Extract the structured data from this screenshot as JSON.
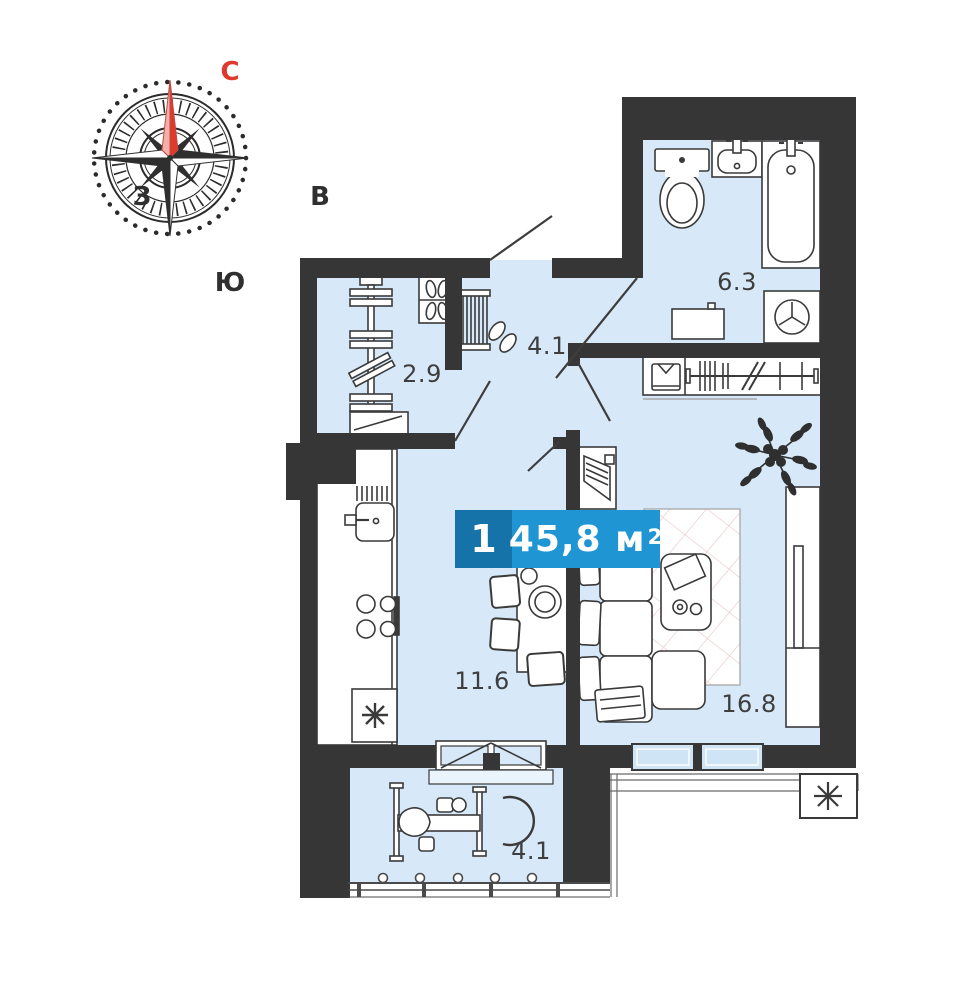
{
  "title": "Floor plan of 1-room apartment",
  "compass": {
    "north": "С",
    "east": "В",
    "south": "Ю",
    "west": "З"
  },
  "badge": {
    "count": "1",
    "area": "45,8",
    "unit": "м",
    "superscript": "2"
  },
  "rooms": [
    {
      "name": "storage",
      "label": "2.9"
    },
    {
      "name": "hallway",
      "label": "4.1"
    },
    {
      "name": "bathroom",
      "label": "6.3"
    },
    {
      "name": "kitchen",
      "label": "11.6"
    },
    {
      "name": "living-room",
      "label": "16.8"
    },
    {
      "name": "balcony",
      "label": "4.1"
    }
  ],
  "colors": {
    "wall": "#363636",
    "room_fill": "#d7e9f8",
    "window_glass": "#cfe5f6",
    "badge_dark": "#1673aa",
    "badge_light": "#2095d3",
    "north_red": "#df382d",
    "rug_line": "#eac9c9",
    "outline": "#3a3a3a"
  },
  "icons": [
    "compass-rose-icon",
    "toilet-icon",
    "washbasin-icon",
    "bathtub-icon",
    "washing-machine-icon",
    "bathroom-cabinet-icon",
    "coat-rack-icon",
    "shirt-icon",
    "plant-icon",
    "tv-stand-icon",
    "sofa-icon",
    "coffee-table-icon",
    "rug-icon",
    "wardrobe-icon",
    "kitchen-sink-icon",
    "stove-icon",
    "fridge-snowflake-icon",
    "dining-table-icon",
    "chair-icon",
    "shelving-icon",
    "shoe-box-icon",
    "shoe-rack-icon",
    "exercise-bike-icon",
    "balcony-railing-icon",
    "air-conditioner-icon",
    "door-swing-icon",
    "window-icon",
    "vent-shaft-icon"
  ]
}
